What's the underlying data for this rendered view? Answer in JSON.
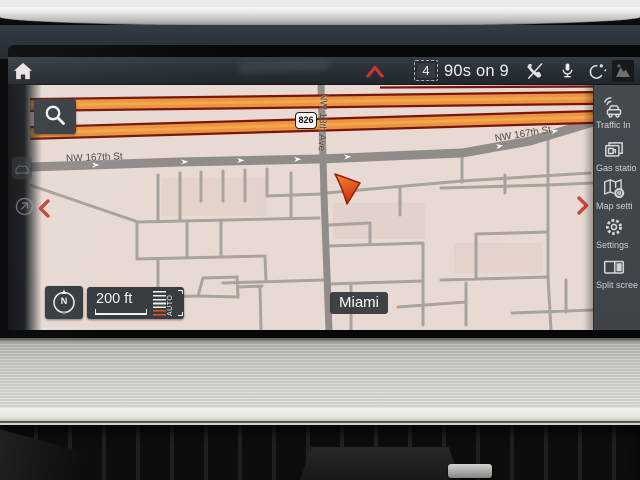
{
  "status_bar": {
    "preset_number": "4",
    "channel_name": "90s on 9"
  },
  "map": {
    "route_shield": "826",
    "main_street_label_left": "NW 167th St",
    "main_street_label_right": "NW 167th St",
    "cross_street_label": "NW 13th Ave",
    "city_label": "Miami",
    "scale_value": "200 ft",
    "zoom_mode": "AUTO",
    "compass_north": "N"
  },
  "sidebar": {
    "items": [
      {
        "id": "traffic-info",
        "label": "Traffic In"
      },
      {
        "id": "gas-stations",
        "label": "Gas statio"
      },
      {
        "id": "map-settings",
        "label": "Map setti"
      },
      {
        "id": "settings",
        "label": "Settings"
      },
      {
        "id": "split-screen",
        "label": "Split scree"
      }
    ]
  },
  "colors": {
    "traffic_orange": "#ea9440",
    "traffic_casing": "#7a150d",
    "chevron_red": "#c4473a",
    "map_background": "#e8dad3",
    "panel_dark": "#40454a"
  }
}
